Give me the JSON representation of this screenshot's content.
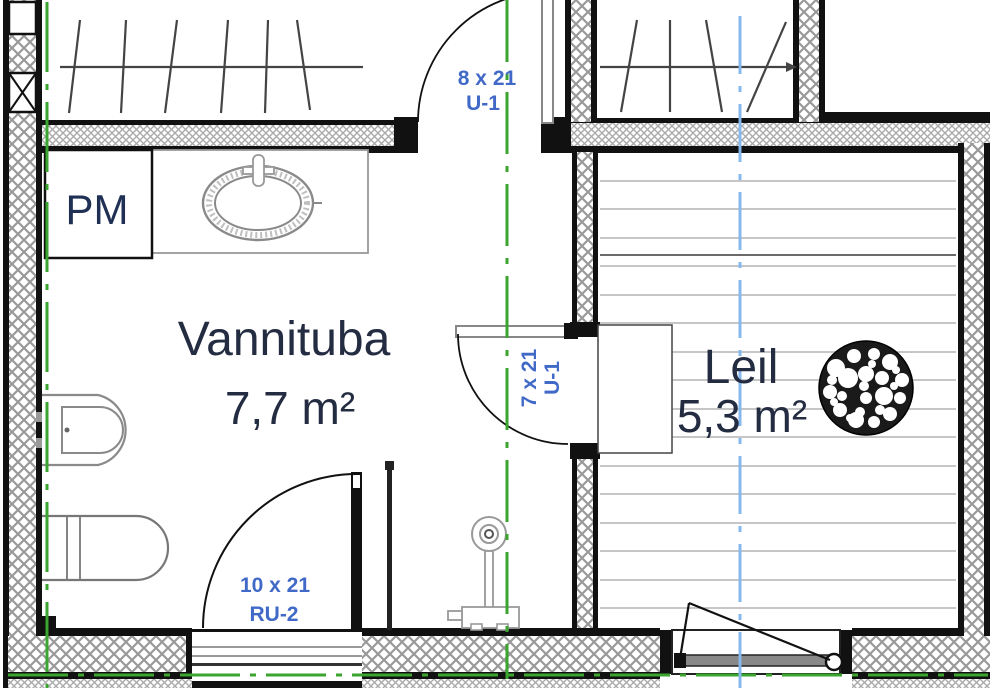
{
  "drawing": {
    "type": "architectural-floor-plan",
    "rooms": [
      {
        "name": "Vannituba",
        "area": "7,7 m²"
      },
      {
        "name": "Leil",
        "area": "5,3 m²"
      }
    ],
    "appliances": {
      "washing_machine": "PM"
    },
    "doors": [
      {
        "size": "8 x 21",
        "code": "U-1"
      },
      {
        "size": "7 x 21",
        "code": "U-1"
      },
      {
        "size": "10 x 21",
        "code": "RU-2"
      }
    ],
    "colors": {
      "room_label": "#242c42",
      "door_label": "#4169c8",
      "pm_label": "#203055",
      "centerline_green": "#3aa52f",
      "centerline_blue": "#85b8ee",
      "wall_black": "#111111",
      "hatch_gray": "#9a9a9a",
      "fixture_gray": "#8a8a8a",
      "plank_gray": "#b4b4b4"
    }
  }
}
